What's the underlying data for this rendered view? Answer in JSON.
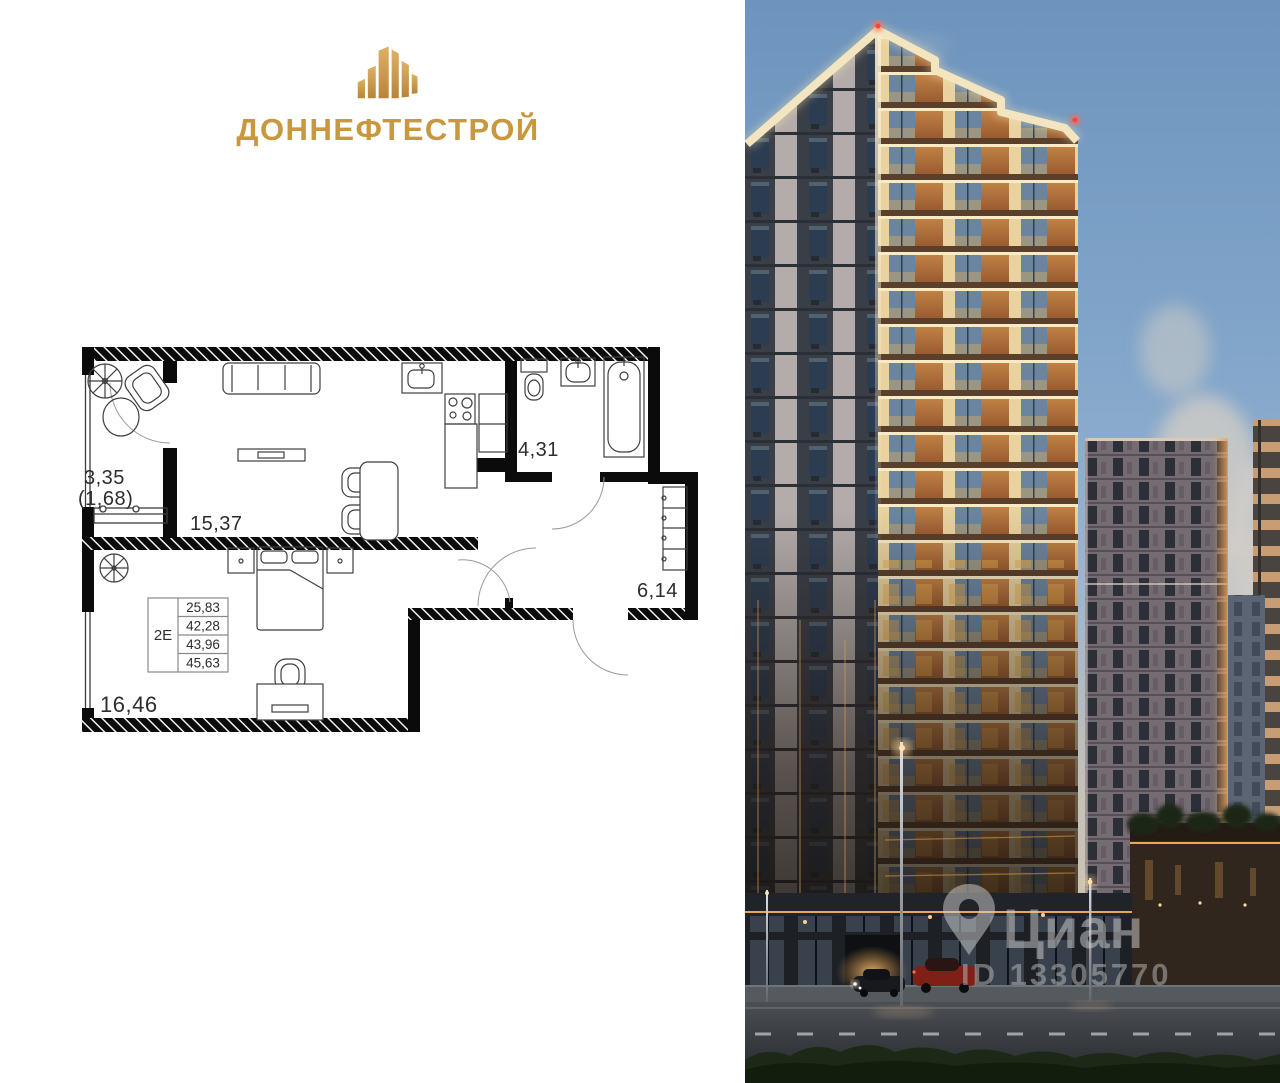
{
  "logo": {
    "title": "ДОННЕФТЕСТРОЙ"
  },
  "floor_plan": {
    "balcony": {
      "area": "3,35",
      "area_reduced": "(1,68)"
    },
    "living_room": {
      "area": "15,37"
    },
    "bathroom": {
      "area": "4,31"
    },
    "hallway": {
      "area": "6,14"
    },
    "bedroom": {
      "area": "16,46"
    },
    "apartment_table": {
      "type": "2Е",
      "rows": [
        "25,83",
        "42,28",
        "43,96",
        "45,63"
      ]
    }
  },
  "watermark": {
    "brand": "Циан",
    "listing_id": "ID 13305770"
  },
  "palette": {
    "logo_gold": "#c9973e",
    "wall_black": "#0b0b0b",
    "sky_blue": "#7da3c8",
    "sunset_panel_orange": "#b3763d",
    "lit_band_cream": "#f5e7c0",
    "watermark_gray": "#cdcdcd"
  }
}
